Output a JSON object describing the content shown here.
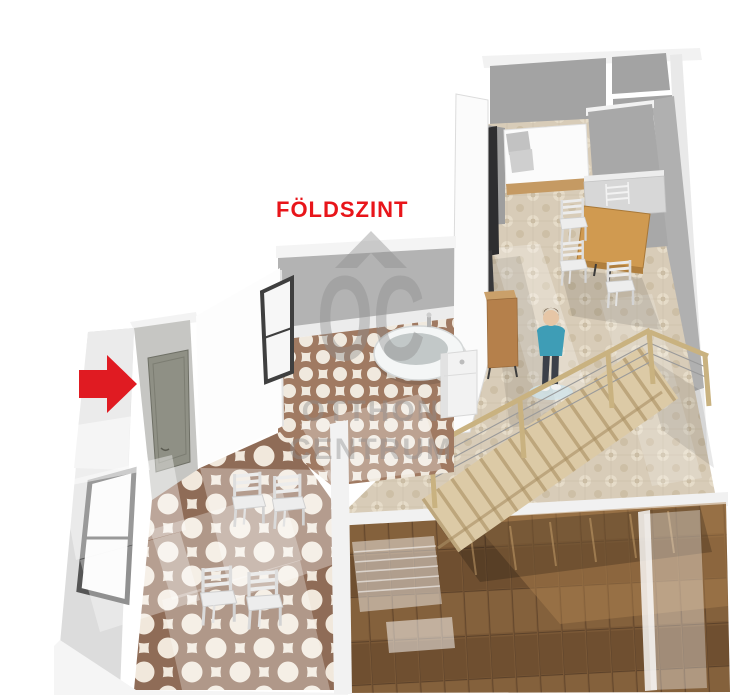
{
  "floor_label": {
    "text": "FÖLDSZINT",
    "color": "#e8151a"
  },
  "entrance_marker": {
    "icon": "red-arrow-right",
    "color": "#e01b22"
  },
  "watermark": {
    "icon": "house-roof-icon",
    "monogram": "OC",
    "line1": "OTTHON",
    "line2": "CENTRUM",
    "color": "#8f8f8f"
  },
  "palette": {
    "wall_gray": "#a8a8a8",
    "wall_light": "#d9d9d9",
    "tile_beige": "#d8ccb8",
    "tile_ring_brown": "#8f6c57",
    "tile_cream": "#f1e8dc",
    "wood_floor": "#7a5836",
    "stair_wood": "#decdab",
    "table_wood": "#d09a50",
    "person_top": "#3e9db6",
    "accent_red": "#e01b22"
  },
  "scene": {
    "type": "3d-floor-plan-ground-floor",
    "objects": [
      "entrance-door",
      "entry-window",
      "side-window",
      "entry-chairs",
      "bathtub",
      "vanity-sink",
      "staircase",
      "stair-railing",
      "person-figure",
      "double-bed",
      "dining-table",
      "dining-chairs",
      "sideboard",
      "wall-tv",
      "kitchen-counter",
      "wood-floor-room",
      "ghost-bed",
      "ghost-bench",
      "ghost-wardrobe"
    ]
  }
}
